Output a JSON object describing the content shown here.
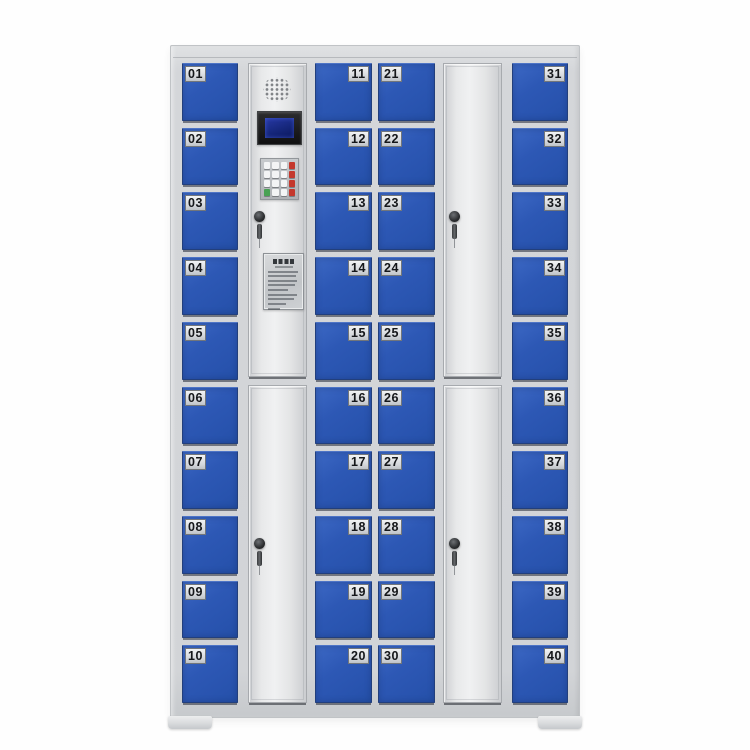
{
  "cabinet": {
    "description": "40-door smart electronic storage locker cabinet",
    "door_count": 40,
    "columns": [
      {
        "id": "bank-1",
        "type": "doors",
        "label_side": "left",
        "numbers": [
          "01",
          "02",
          "03",
          "04",
          "05",
          "06",
          "07",
          "08",
          "09",
          "10"
        ]
      },
      {
        "id": "control-column",
        "type": "control",
        "components": [
          "speaker-grille",
          "lcd-display",
          "keypad",
          "key-lock",
          "instruction-placard",
          "lower-service-door"
        ]
      },
      {
        "id": "bank-2",
        "type": "doors",
        "label_side": "right",
        "numbers": [
          "11",
          "12",
          "13",
          "14",
          "15",
          "16",
          "17",
          "18",
          "19",
          "20"
        ]
      },
      {
        "id": "bank-3",
        "type": "doors",
        "label_side": "left",
        "numbers": [
          "21",
          "22",
          "23",
          "24",
          "25",
          "26",
          "27",
          "28",
          "29",
          "30"
        ]
      },
      {
        "id": "large-door-column",
        "type": "large-doors",
        "components": [
          "upper-door-with-key-lock",
          "lower-door-with-key-lock"
        ]
      },
      {
        "id": "bank-4",
        "type": "doors",
        "label_side": "right",
        "numbers": [
          "31",
          "32",
          "33",
          "34",
          "35",
          "36",
          "37",
          "38",
          "39",
          "40"
        ]
      }
    ],
    "feet": [
      "left-foot",
      "right-foot"
    ]
  },
  "keypad": {
    "rows": [
      [
        "white",
        "white",
        "white",
        "red"
      ],
      [
        "white",
        "white",
        "white",
        "red"
      ],
      [
        "white",
        "white",
        "white",
        "red"
      ],
      [
        "green",
        "white",
        "white",
        "red"
      ]
    ]
  },
  "colors": {
    "door_blue": "#2d58b5",
    "frame_gray": "#d2d4d7",
    "panel_white": "#e8e9ea",
    "plate_silver": "#d3d6da",
    "number_black": "#15171a",
    "lcd_screen_blue": "#16277c",
    "key_red": "#c4382d",
    "key_green": "#49a254",
    "background": "#fefefe"
  }
}
